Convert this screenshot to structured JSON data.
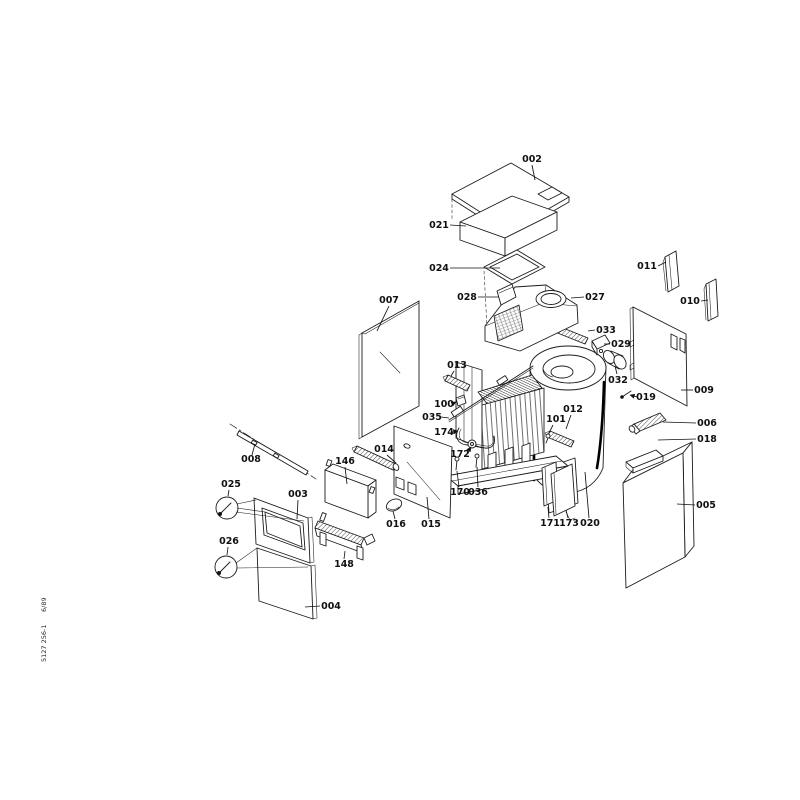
{
  "meta": {
    "doc_number": "5127 256-1",
    "edition": "6/89"
  },
  "parts": [
    {
      "label": "002",
      "x": 532,
      "y": 162,
      "leader": [
        [
          532,
          165
        ],
        [
          535,
          180
        ]
      ]
    },
    {
      "label": "021",
      "x": 439,
      "y": 228,
      "leader": [
        [
          450,
          225
        ],
        [
          466,
          226
        ]
      ]
    },
    {
      "label": "024",
      "x": 439,
      "y": 271,
      "leader": [
        [
          450,
          268
        ],
        [
          500,
          268
        ]
      ]
    },
    {
      "label": "028",
      "x": 467,
      "y": 300,
      "leader": [
        [
          478,
          297
        ],
        [
          499,
          297
        ]
      ]
    },
    {
      "label": "027",
      "x": 595,
      "y": 300,
      "leader": [
        [
          584,
          297
        ],
        [
          571,
          298
        ]
      ]
    },
    {
      "label": "007",
      "x": 389,
      "y": 303,
      "leader": [
        [
          389,
          306
        ],
        [
          377,
          331
        ]
      ]
    },
    {
      "label": "011",
      "x": 647,
      "y": 269,
      "leader": [
        [
          658,
          266
        ],
        [
          666,
          262
        ]
      ]
    },
    {
      "label": "010",
      "x": 690,
      "y": 304,
      "leader": [
        [
          701,
          301
        ],
        [
          708,
          300
        ]
      ]
    },
    {
      "label": "033",
      "x": 606,
      "y": 333,
      "leader": [
        [
          595,
          330
        ],
        [
          588,
          331
        ]
      ]
    },
    {
      "label": "029",
      "x": 621,
      "y": 347,
      "leader": [
        [
          610,
          344
        ],
        [
          604,
          344
        ]
      ]
    },
    {
      "label": "013",
      "x": 457,
      "y": 368,
      "leader": [
        [
          454,
          371
        ],
        [
          451,
          376
        ]
      ]
    },
    {
      "label": "032",
      "x": 618,
      "y": 383,
      "leader": [
        [
          617,
          374
        ],
        [
          615,
          366
        ]
      ]
    },
    {
      "label": "019",
      "x": 646,
      "y": 400,
      "arrow": true,
      "leader": [
        [
          637,
          397
        ],
        [
          630,
          395
        ]
      ]
    },
    {
      "label": "009",
      "x": 704,
      "y": 393,
      "leader": [
        [
          693,
          390
        ],
        [
          681,
          390
        ]
      ]
    },
    {
      "label": "006",
      "x": 707,
      "y": 426,
      "leader": [
        [
          696,
          423
        ],
        [
          663,
          422
        ]
      ]
    },
    {
      "label": "018",
      "x": 707,
      "y": 442,
      "leader": [
        [
          696,
          439
        ],
        [
          658,
          440
        ]
      ]
    },
    {
      "label": "100",
      "x": 444,
      "y": 407,
      "arrow": true,
      "leader": [
        [
          452,
          404
        ],
        [
          456,
          402
        ]
      ]
    },
    {
      "label": "035",
      "x": 432,
      "y": 420,
      "leader": [
        [
          441,
          417
        ],
        [
          449,
          418
        ]
      ]
    },
    {
      "label": "174",
      "x": 444,
      "y": 435,
      "arrow": true,
      "leader": [
        [
          452,
          432
        ],
        [
          458,
          431
        ]
      ]
    },
    {
      "label": "014",
      "x": 384,
      "y": 452,
      "leader": [
        [
          387,
          455
        ],
        [
          396,
          463
        ]
      ]
    },
    {
      "label": "012",
      "x": 573,
      "y": 412,
      "leader": [
        [
          571,
          415
        ],
        [
          566,
          429
        ]
      ]
    },
    {
      "label": "101",
      "x": 556,
      "y": 422,
      "leader": [
        [
          553,
          425
        ],
        [
          549,
          433
        ]
      ]
    },
    {
      "label": "172",
      "x": 460,
      "y": 457,
      "arrow": true,
      "leader": [
        [
          467,
          453
        ],
        [
          471,
          447
        ]
      ]
    },
    {
      "label": "008",
      "x": 251,
      "y": 462,
      "leader": [
        [
          252,
          455
        ],
        [
          255,
          444
        ]
      ]
    },
    {
      "label": "146",
      "x": 345,
      "y": 464,
      "leader": [
        [
          345,
          467
        ],
        [
          347,
          484
        ]
      ]
    },
    {
      "label": "025",
      "x": 231,
      "y": 487,
      "leader": [
        [
          229,
          490
        ],
        [
          228,
          496
        ]
      ]
    },
    {
      "label": "003",
      "x": 298,
      "y": 497,
      "leader": [
        [
          298,
          500
        ],
        [
          297,
          519
        ]
      ]
    },
    {
      "label": "170",
      "x": 460,
      "y": 495,
      "leader": [
        [
          459,
          487
        ],
        [
          457,
          471
        ]
      ]
    },
    {
      "label": "036",
      "x": 478,
      "y": 495,
      "leader": [
        [
          478,
          487
        ],
        [
          477,
          467
        ]
      ]
    },
    {
      "label": "016",
      "x": 396,
      "y": 527,
      "leader": [
        [
          395,
          519
        ],
        [
          393,
          511
        ]
      ]
    },
    {
      "label": "015",
      "x": 431,
      "y": 527,
      "leader": [
        [
          429,
          519
        ],
        [
          427,
          497
        ]
      ]
    },
    {
      "label": "171",
      "x": 550,
      "y": 526,
      "leader": [
        [
          549,
          518
        ],
        [
          548,
          507
        ]
      ]
    },
    {
      "label": "173",
      "x": 569,
      "y": 526,
      "leader": [
        [
          568,
          518
        ],
        [
          566,
          510
        ]
      ]
    },
    {
      "label": "020",
      "x": 590,
      "y": 526,
      "leader": [
        [
          589,
          518
        ],
        [
          585,
          472
        ]
      ]
    },
    {
      "label": "026",
      "x": 229,
      "y": 544,
      "leader": [
        [
          228,
          547
        ],
        [
          227,
          555
        ]
      ]
    },
    {
      "label": "005",
      "x": 706,
      "y": 508,
      "leader": [
        [
          695,
          505
        ],
        [
          677,
          504
        ]
      ]
    },
    {
      "label": "148",
      "x": 344,
      "y": 567,
      "leader": [
        [
          344,
          559
        ],
        [
          345,
          551
        ]
      ]
    },
    {
      "label": "004",
      "x": 331,
      "y": 609,
      "leader": [
        [
          320,
          606
        ],
        [
          305,
          607
        ]
      ]
    }
  ]
}
